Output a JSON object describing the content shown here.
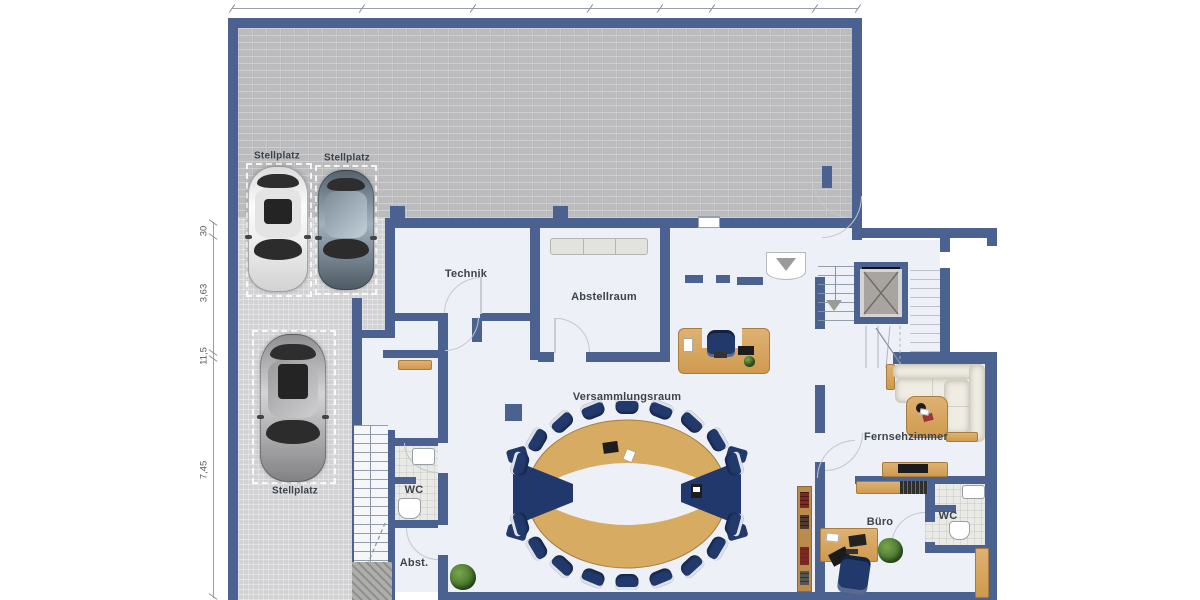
{
  "plan": {
    "type": "floor-plan",
    "left_dimensions": [
      "30",
      "3,63",
      "11,5",
      "7,45"
    ],
    "parking_stalls": [
      {
        "label": "Stellplatz"
      },
      {
        "label": "Stellplatz"
      },
      {
        "label": "Stellplatz"
      }
    ],
    "rooms": {
      "technik": "Technik",
      "abstellraum": "Abstellraum",
      "versammlungsraum": "Versammlungsraum",
      "fernsehzimmer": "Fernsehzimmer",
      "buero": "Büro",
      "wc_main": "WC",
      "wc_small": "WC",
      "abstellkammer": "Abst."
    },
    "colors": {
      "wall": "#4b6190",
      "floor": "#edf0f6",
      "terrace": "#bcbcbe",
      "parking": "#d2d2d4",
      "wood": "#d3a05a",
      "navy": "#21396b",
      "tile": "#e9e9e6",
      "sofa": "#efece3",
      "elev": "#a8a4a0",
      "plant": "#4e7d33"
    }
  }
}
